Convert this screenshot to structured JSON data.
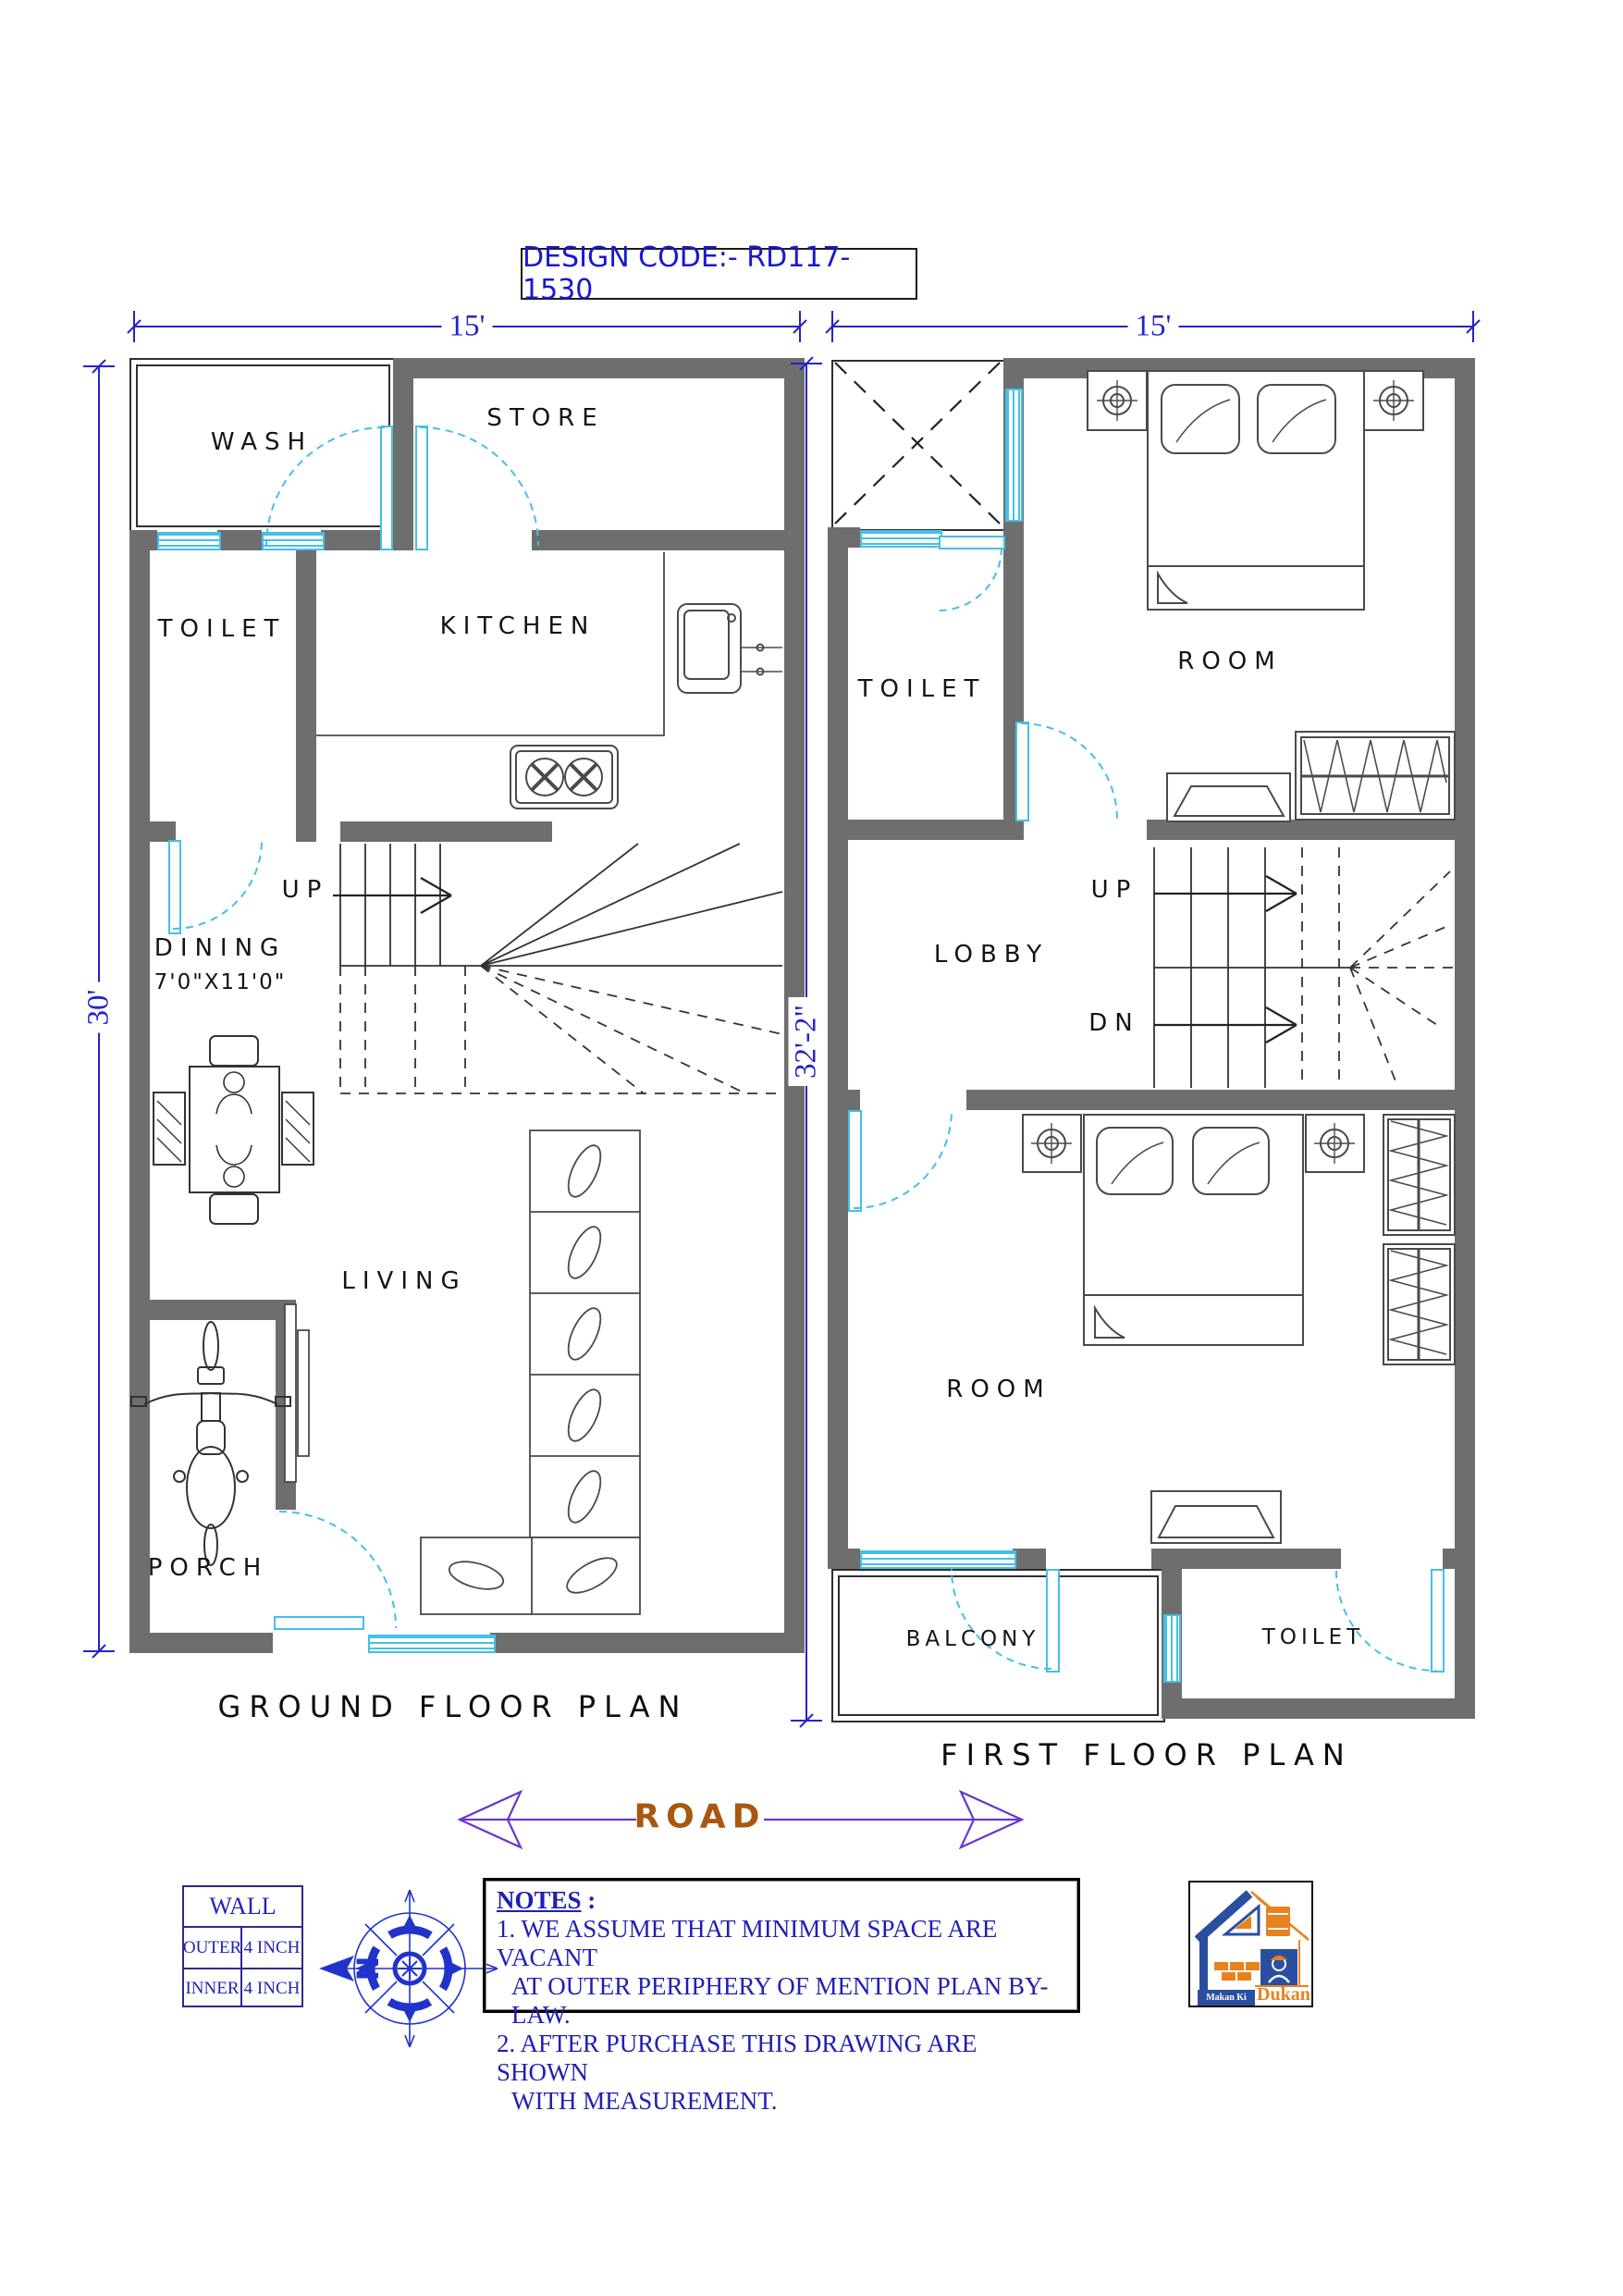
{
  "design_code": "DESIGN CODE:- RD117-1530",
  "ground_floor": {
    "caption": "GROUND FLOOR PLAN",
    "dim_top": "15'",
    "dim_left": "30'",
    "labels": {
      "wash": "WASH",
      "store": "STORE",
      "toilet": "TOILET",
      "kitchen": "KITCHEN",
      "dining_line1": "DINING",
      "dining_line2": "7'0\"X11'0\"",
      "up": "UP",
      "living": "LIVING",
      "porch": "PORCH"
    }
  },
  "first_floor": {
    "caption": "FIRST FLOOR PLAN",
    "dim_top": "15'",
    "dim_left": "32'-2\"",
    "labels": {
      "toilet_top": "TOILET",
      "room_top": "ROOM",
      "lobby": "LOBBY",
      "up": "UP",
      "dn": "DN",
      "room_bottom": "ROOM",
      "balcony": "BALCONY",
      "toilet_bottom": "TOILET"
    }
  },
  "road": {
    "label": "ROAD"
  },
  "compass": {
    "north": "N"
  },
  "wall_table": {
    "header": "WALL",
    "rows": [
      [
        "OUTER",
        "4 INCH"
      ],
      [
        "INNER",
        "4 INCH"
      ]
    ]
  },
  "notes": {
    "heading": "NOTES",
    "heading_suffix": " :",
    "lines": [
      "1. WE ASSUME THAT MINIMUM SPACE ARE VACANT",
      "AT OUTER PERIPHERY OF MENTION PLAN BY-LAW.",
      "2. AFTER PURCHASE THIS DRAWING ARE SHOWN",
      "WITH  MEASUREMENT."
    ]
  },
  "logo": {
    "brand_1": "Makan Ki",
    "brand_2": "Dukan"
  },
  "colors": {
    "wall": "#6e6e6e",
    "opening": "#45bfe8",
    "dimension": "#2323cc",
    "notes_text": "#1f1fb4",
    "road_text": "#a8580f",
    "road_arrow": "#6a35cf",
    "logo_blue": "#2b4fa0",
    "logo_orange": "#e8821e"
  }
}
